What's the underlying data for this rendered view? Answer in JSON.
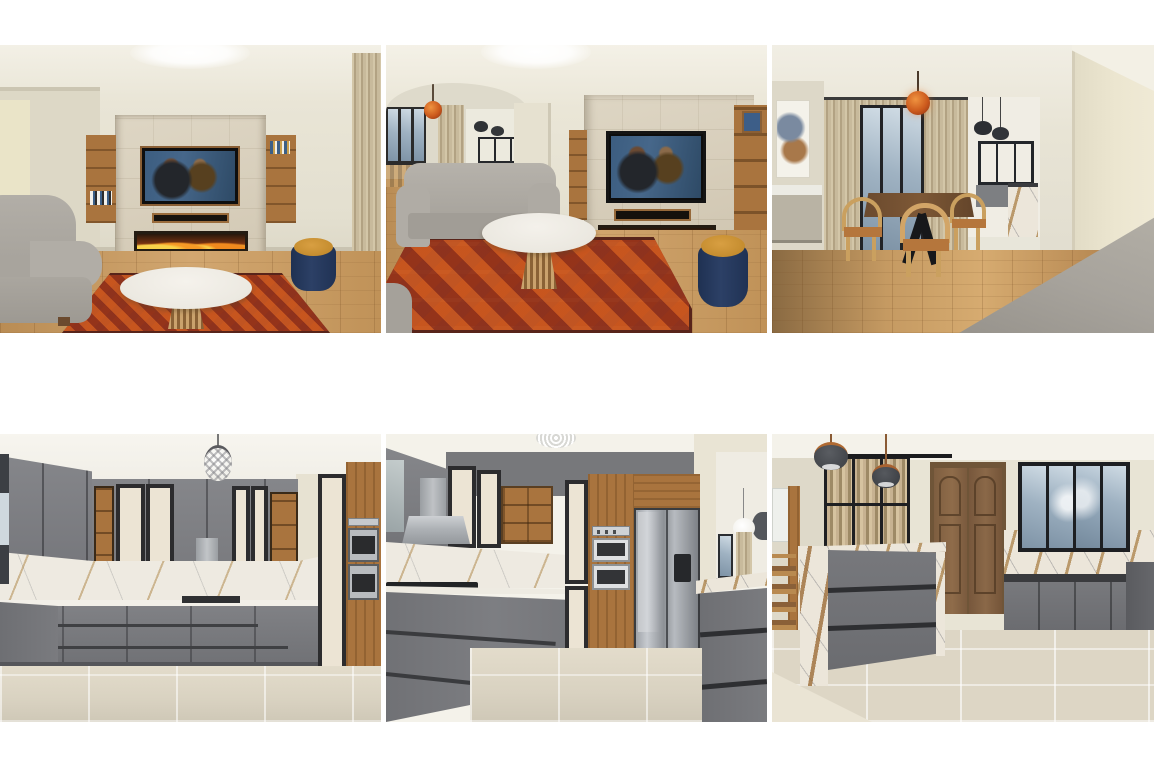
{
  "page": {
    "background_color": "#ffffff",
    "content_type": "interior-design-3d-render-collage",
    "layout": "2 rows x 3 columns of rendered photos, white margins, no text"
  },
  "grid": {
    "rows": 2,
    "columns": 3,
    "gap_px": 5,
    "top_margin_px": 45,
    "row_gap_px": 101,
    "tile_width_px": 381,
    "tile_height_px": 288
  },
  "renders": [
    {
      "id": "living-room-front",
      "label": "Living room, front view: stone TV feature wall with wall-mounted TV playing a movie, soundbar niche, linear fireplace with flames, wooden display shelves on both sides, gray sofa at left, round white marble coffee table, oriental red rug, navy and mustard pouf, beige curtain at right, wood floor",
      "colors": {
        "wall": "#e7e3d4",
        "stone_panel": "#d8cfbc",
        "shelf_wood": "#aa7440",
        "fire": "#e3641c",
        "sofa": "#a8a49d",
        "rug": "#8a3b22",
        "pouf_navy": "#27395c",
        "pouf_mustard": "#cb9134",
        "floor": "#c89e6c"
      }
    },
    {
      "id": "living-room-angled",
      "label": "Living room, angled view: arched opening to dining area with orange pendant and black-framed windows at left, gray sofa and round marble coffee table over a large diamond-pattern oriental rug, stone TV wall with fireplace at right, wooden shelving unit at right edge, navy and mustard pouf",
      "colors": {
        "wall": "#e9e5d6",
        "arch": "#ebe7d8",
        "pendant_orange": "#c0511c",
        "glass": "#9fb2c2",
        "rug": "#8a3b22",
        "stone_panel": "#d7ceba"
      }
    },
    {
      "id": "dining-room",
      "label": "Dining room seen over the back of a gray sofa: dark wood dining table with black cross legs, light wood hoop-back chairs with orange seats, orange glass pendant, beige curtains with black-framed glass doors, abstract artwork and white sideboard at left, opening to kitchen with two black pendants at right, wood floor",
      "colors": {
        "wall": "#e6e2d3",
        "pendant_orange": "#c0511c",
        "table_wood": "#6b4a2e",
        "chair_wood": "#d2a567",
        "sofa_back": "#a7a39c",
        "floor": "#c59a62"
      }
    },
    {
      "id": "kitchen-corner",
      "label": "Kitchen, corner view: gray upper and lower cabinets, cream doors with black frames, wooden open shelves, marble backsplash with gold veining, stainless range hood and cooktop, tall wood column with double wall ovens, crystal sphere pendant, beige tile floor",
      "colors": {
        "cabinet_gray": "#7d7e81",
        "cream_door": "#ece4d4",
        "frame_black": "#2c2c2e",
        "marble": "#eeeae1",
        "wood": "#a9743e",
        "stainless": "#b9bcbf",
        "floor_tile": "#dcd5c4"
      }
    },
    {
      "id": "kitchen-fridge",
      "label": "Kitchen, view toward tall units: gray perspective cabinets with cooktop and hood at left, cream-framed tall door, wood oven column with stacked double ovens, stainless side-by-side fridge, gray island with marble top at right, opening to living area with white globe pendant top right, beige tile floor",
      "colors": {
        "cabinet_gray": "#7a7b7e",
        "wood": "#a9743e",
        "fridge_steel": "#aab0b6",
        "marble": "#e9e4da",
        "wall_band": "#77787b"
      }
    },
    {
      "id": "kitchen-island",
      "label": "Kitchen, island view: gray drawer island with marble waterfall end panels, two dark dome pendants, black-framed glass partition with gold curtains, double wooden doors in the corner, large black-framed window with sky reflection over gray base cabinets and marble backsplash, beige tile floor",
      "colors": {
        "island_gray": "#6f7074",
        "marble": "#ece6da",
        "pendant_dome": "#4a4d52",
        "door_wood": "#8a6848",
        "window_frame": "#1d1f22",
        "glass": "#9fb2c2",
        "floor_tile": "#ddd6c5"
      }
    }
  ],
  "palette": {
    "page_white": "#ffffff",
    "wall_beige": "#e7e3d4",
    "ceiling_white": "#f4f2ec",
    "stone_beige": "#d8cfbc",
    "wood_warm": "#a9743e",
    "cabinet_gray": "#7d7e81",
    "cream": "#ece4d4",
    "black_frame": "#2c2c2e",
    "marble_white": "#eeeae1",
    "navy": "#27395c",
    "mustard": "#cb9134",
    "fire_orange": "#e3641c",
    "glass_blue": "#9fb2c2",
    "wood_floor": "#c89e6c",
    "tile_floor": "#dcd5c4"
  }
}
